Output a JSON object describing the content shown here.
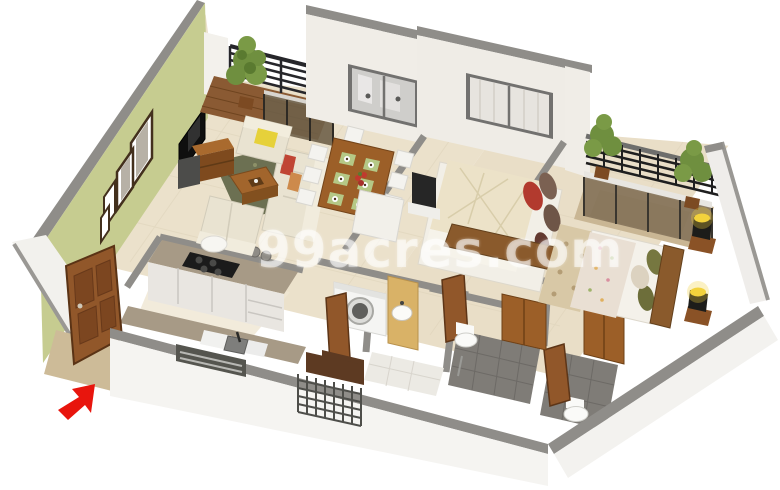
{
  "watermark": {
    "text": "99acres.com",
    "color": "rgba(255,255,255,0.55)"
  },
  "scene": {
    "title": "3D isometric apartment floor plan render",
    "style": "cutaway 3D dollhouse view of a 2-BHK flat on a white background",
    "entrance": {
      "indicator": "red-arrow",
      "color": "#e8150d"
    }
  },
  "colors": {
    "background": "#ffffff",
    "accent_wall": "#c6cc90",
    "wall_cap_gray": "#8f8d89",
    "wall_white": "#f0ede7",
    "floor_beige": "#ebe1cb",
    "floor_beige2": "#e9dec7",
    "wood_brown": "#91572a",
    "wood_dark": "#5d3a22",
    "granite": "#a79a86",
    "sofa_cream": "#e9e3d1",
    "rug_green": "#6c7052",
    "bathroom_tile": "#7f7c77",
    "red_arrow": "#e8150d",
    "lamp_glow": "#f2d23c",
    "plant_green": "#6f8f3f",
    "railing_black": "#26262a"
  },
  "rooms": [
    {
      "name": "living-room",
      "contents": [
        "green-accent-wall",
        "picture-frames",
        "wall-tv",
        "tv-console",
        "sofa-set",
        "armchair",
        "coffee-table",
        "rug"
      ]
    },
    {
      "name": "living-balcony",
      "contents": [
        "black-railing",
        "potted-plant",
        "wood-deck",
        "glass-door"
      ]
    },
    {
      "name": "dining-area",
      "contents": [
        "wooden-dining-table",
        "white-chairs",
        "placemats",
        "crockery"
      ]
    },
    {
      "name": "kitchen",
      "contents": [
        "granite-counter",
        "gas-hob",
        "cabinets",
        "sink",
        "window"
      ]
    },
    {
      "name": "utility-area",
      "contents": [
        "washing-machine",
        "wash-basin",
        "wooden-doors"
      ]
    },
    {
      "name": "utility-balcony",
      "contents": [
        "safety-grill",
        "dark-wood-floor"
      ]
    },
    {
      "name": "bathroom-1",
      "contents": [
        "toilet",
        "gray-tiles",
        "shower"
      ]
    },
    {
      "name": "bathroom-2",
      "contents": [
        "toilet",
        "gray-tiles",
        "wooden-door"
      ]
    },
    {
      "name": "master-bedroom",
      "contents": [
        "double-bed",
        "quilt",
        "pillows",
        "wardrobe",
        "tv-unit",
        "window-with-curtains"
      ]
    },
    {
      "name": "bedroom-2",
      "contents": [
        "double-bed",
        "floral-quilt",
        "green-bolsters",
        "bedside-lamps",
        "wardrobe",
        "rug"
      ]
    },
    {
      "name": "bedroom-balcony",
      "contents": [
        "pergola-grill",
        "sliding-glass-doors",
        "potted-plants"
      ]
    },
    {
      "name": "entrance",
      "contents": [
        "wooden-main-door",
        "red-entry-arrow"
      ]
    }
  ]
}
